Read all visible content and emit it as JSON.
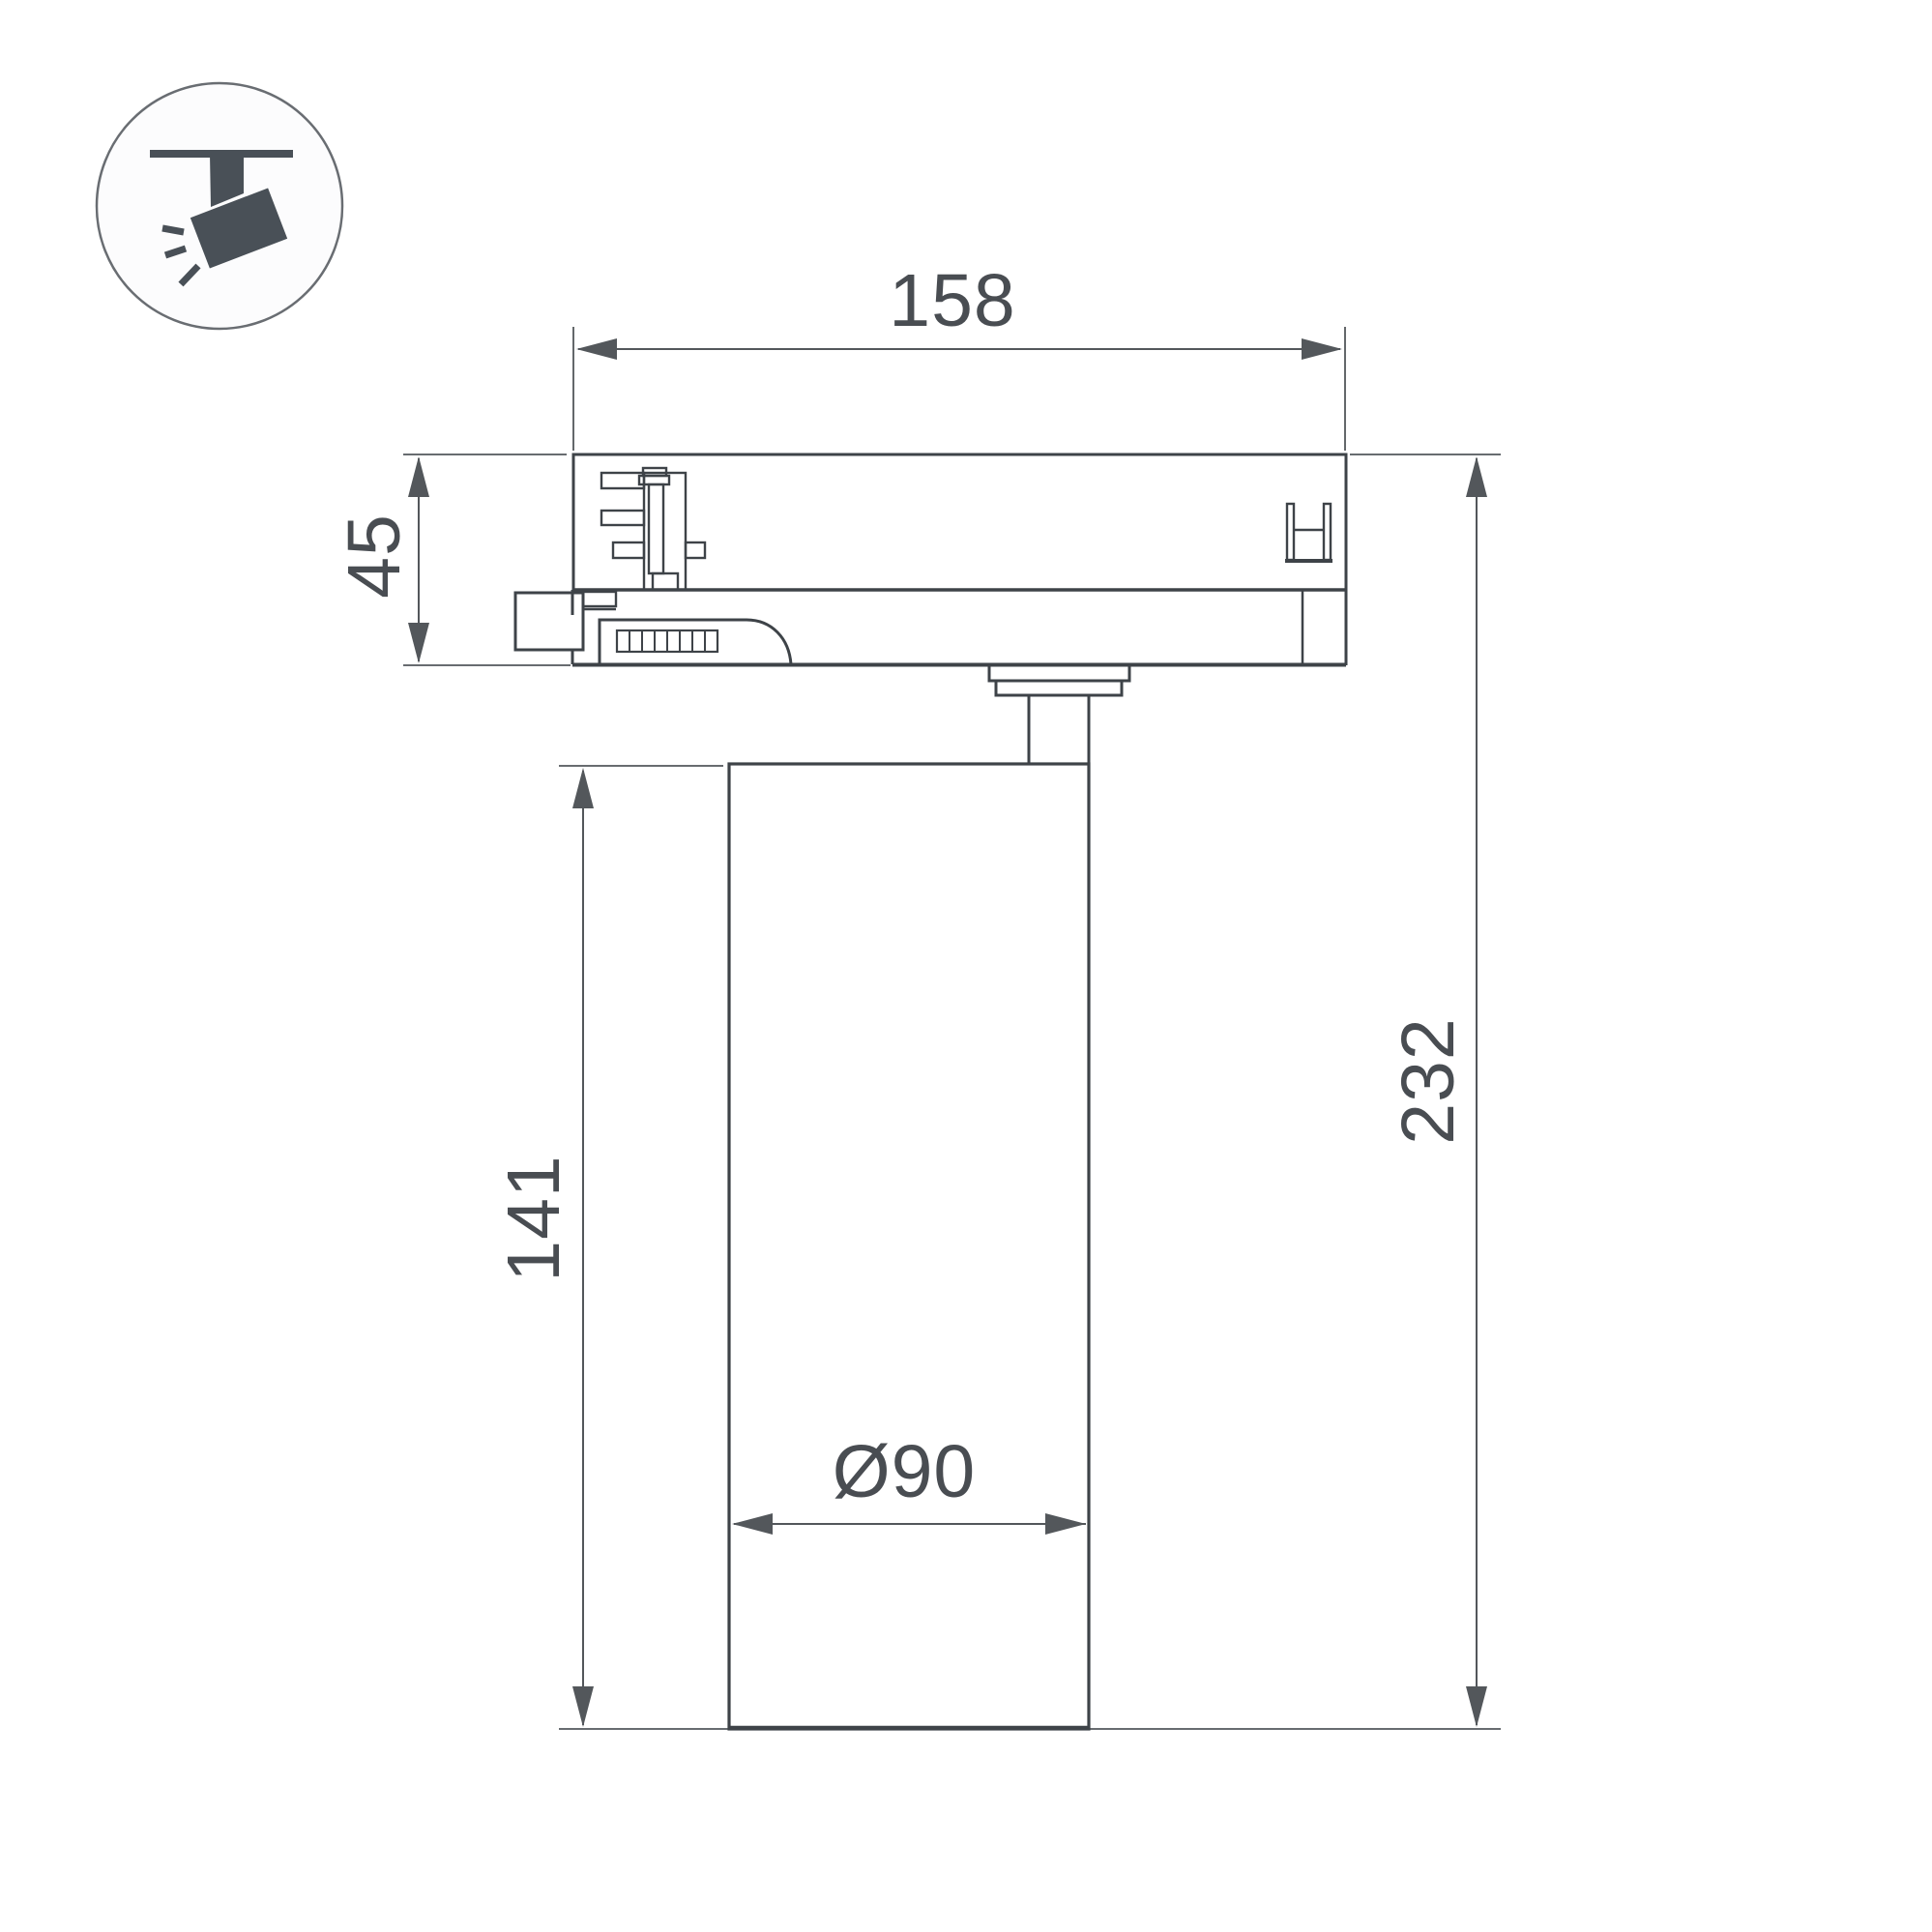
{
  "page": {
    "background": "#ffffff",
    "description": "Technical dimension drawing of a track-mounted spotlight (side view)"
  },
  "icon": {
    "semantic": "track-spotlight-category-icon",
    "fill": "#495057",
    "circle_stroke": "#696d72",
    "circle_fill": "#fcfcfd"
  },
  "drawing": {
    "line_color": "#3e4348",
    "dim_color": "#53575b",
    "text_color": "#494d52",
    "dimensions": {
      "adapter_width": "158",
      "adapter_height": "45",
      "body_height": "141",
      "total_height": "232",
      "body_diameter": "Ø90"
    }
  }
}
